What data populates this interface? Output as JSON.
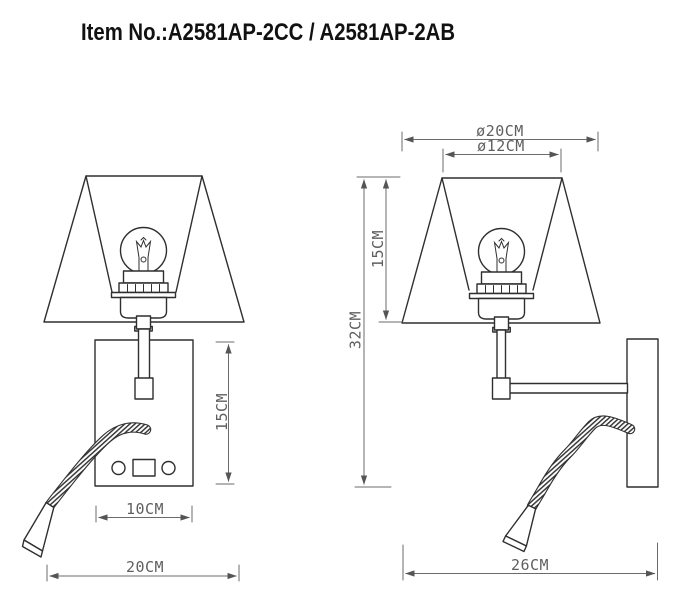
{
  "title": "Item No.:A2581AP-2CC / A2581AP-2AB",
  "front_view": {
    "dimensions": {
      "back_plate_height": "15CM",
      "back_plate_width": "10CM",
      "overall_width": "20CM"
    }
  },
  "side_view": {
    "dimensions": {
      "shade_bottom_diameter": "ø20CM",
      "shade_top_diameter": "ø12CM",
      "shade_height": "15CM",
      "overall_height": "32CM",
      "overall_depth": "26CM"
    }
  },
  "colors": {
    "background": "#ffffff",
    "object_line": "#2f2f2f",
    "dimension_line": "#6b6b6b",
    "dimension_text": "#5f5f5f",
    "title_text": "#111111"
  }
}
